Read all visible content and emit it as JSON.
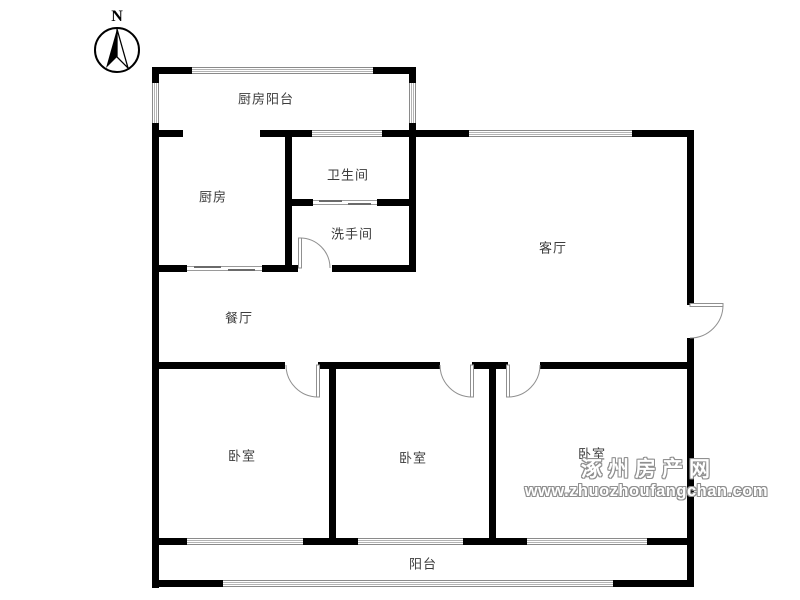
{
  "compass": {
    "label": "N"
  },
  "rooms": {
    "kitchen_balcony": "厨房阳台",
    "kitchen": "厨房",
    "bathroom": "卫生间",
    "washroom": "洗手间",
    "living_room": "客厅",
    "dining_room": "餐厅",
    "bedroom_left": "卧室",
    "bedroom_middle": "卧室",
    "bedroom_right": "卧室",
    "balcony": "阳台"
  },
  "watermark": {
    "site_name": "涿州房产网",
    "site_url": "www.zhuozhoufangchan.com"
  },
  "colors": {
    "wall": "#000000",
    "room_label": "#3c3c3c",
    "window_line": "#8a8a8a",
    "watermark_outline": "#8f8f8f",
    "background": "#ffffff"
  }
}
